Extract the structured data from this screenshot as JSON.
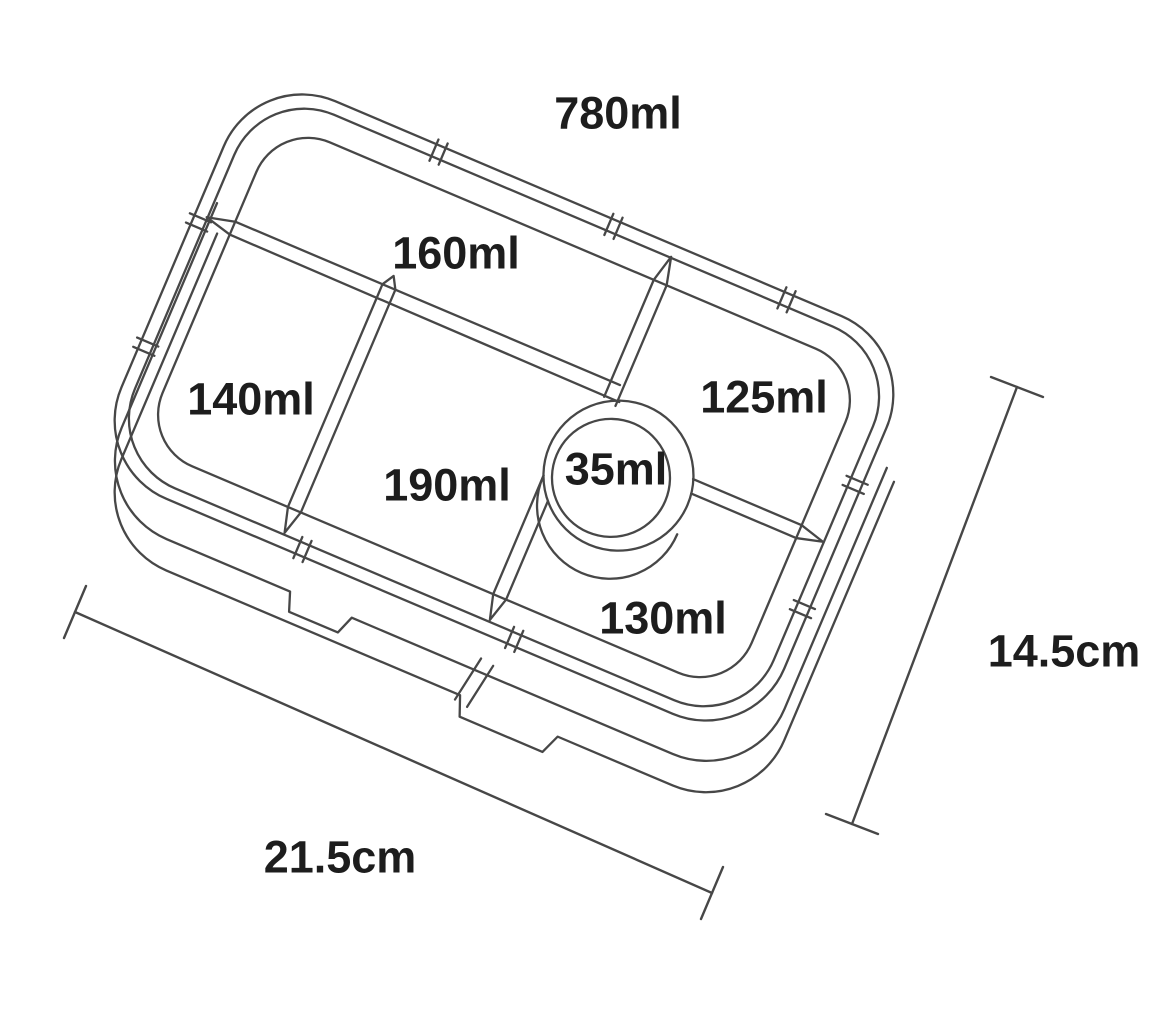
{
  "diagram": {
    "labels": {
      "total_volume": "780ml",
      "compartment_top": "160ml",
      "compartment_left": "140ml",
      "compartment_right": "125ml",
      "compartment_center": "190ml",
      "compartment_round": "35ml",
      "compartment_bottom": "130ml"
    },
    "dimensions": {
      "length": "21.5cm",
      "depth": "14.5cm"
    },
    "colors": {
      "background": "#ffffff",
      "line": "#474747",
      "text": "#1d1d1d"
    }
  }
}
